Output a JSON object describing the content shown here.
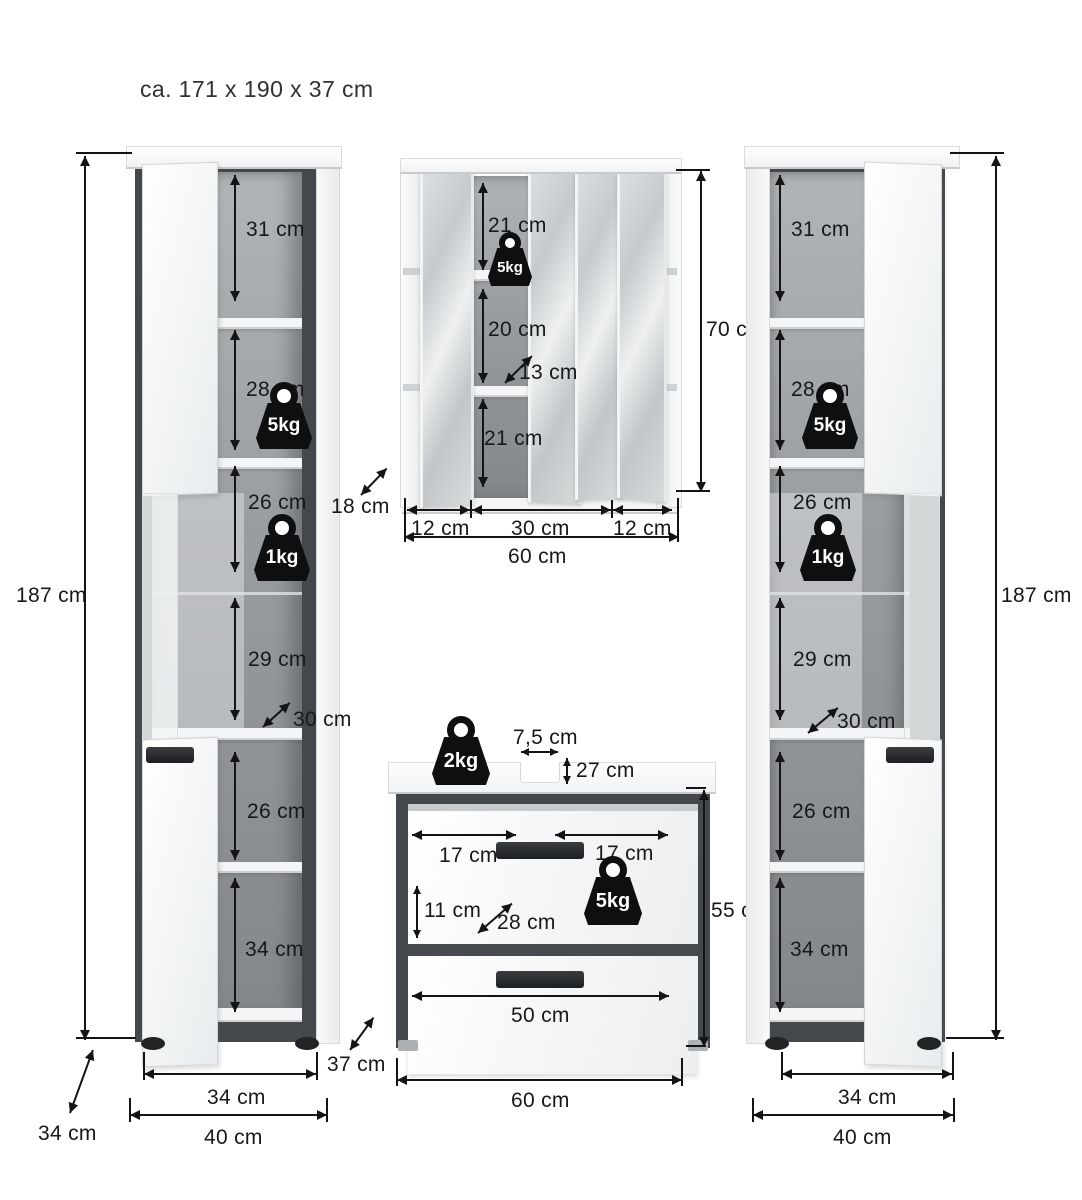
{
  "title": "ca. 171 x 190 x 37 cm",
  "left_cabinet": {
    "height": "187 cm",
    "compartments": [
      "31 cm",
      "28 cm",
      "26 cm",
      "29 cm",
      "26 cm",
      "34 cm"
    ],
    "load_upper": "5kg",
    "load_middle": "1kg",
    "shelf_depth": "30 cm",
    "inner_width": "34 cm",
    "outer_width": "40 cm",
    "depth": "34 cm"
  },
  "mirror_cabinet": {
    "height": "70 cm",
    "compartments": [
      "21 cm",
      "20 cm",
      "21 cm"
    ],
    "load": "5kg",
    "shelf_depth": "13 cm",
    "depth": "18 cm",
    "section_widths": [
      "12 cm",
      "30 cm",
      "12 cm"
    ],
    "outer_width": "60 cm"
  },
  "vanity": {
    "top_load": "2kg",
    "cutout_width": "7,5 cm",
    "cutout_offset": "27 cm",
    "drawer_left": "17 cm",
    "drawer_right": "17 cm",
    "drawer_height": "11 cm",
    "inner_depth": "28 cm",
    "drawer_load": "5kg",
    "height": "55 cm",
    "lower_drawer_width": "50 cm",
    "outer_width": "60 cm",
    "gap_depth": "37 cm"
  },
  "right_cabinet": {
    "height": "187 cm",
    "compartments": [
      "31 cm",
      "28 cm",
      "26 cm",
      "29 cm",
      "26 cm",
      "34 cm"
    ],
    "load_upper": "5kg",
    "load_middle": "1kg",
    "shelf_depth": "30 cm",
    "inner_width": "34 cm",
    "outer_width": "40 cm",
    "depth": "34 cm"
  }
}
